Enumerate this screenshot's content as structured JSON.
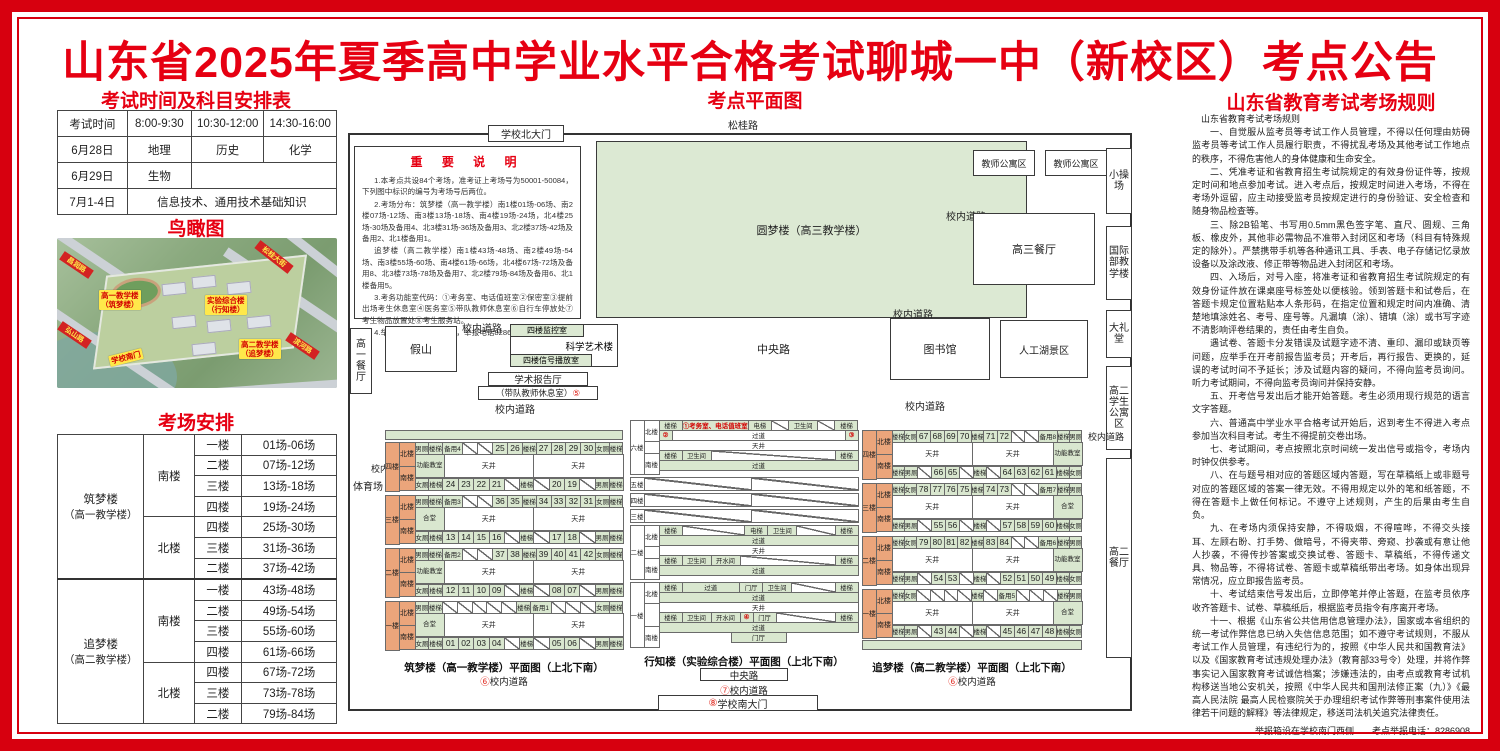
{
  "title": "山东省2025年夏季高中学业水平合格考试聊城一中（新校区）考点公告",
  "left": {
    "schedule": {
      "title": "考试时间及科目安排表",
      "header": [
        "考试时间",
        "8:00-9:30",
        "10:30-12:00",
        "14:30-16:00"
      ],
      "row1": [
        "6月28日",
        "地理",
        "历史",
        "化学"
      ],
      "row2": [
        "6月29日",
        "生物"
      ],
      "row3": [
        "7月1-4日",
        "信息技术、通用技术基础知识"
      ]
    },
    "aerial": {
      "title": "鸟瞰图",
      "labels": [
        {
          "text": "高一教学楼（筑梦楼）",
          "two": "高一教学楼|（筑梦楼）",
          "x": 42,
          "y": 52
        },
        {
          "text": "实验综合楼（行知楼）",
          "two": "实验综合楼|（行知楼）",
          "x": 148,
          "y": 57
        },
        {
          "text": "高二教学楼（追梦楼）",
          "two": "高二教学楼|（追梦楼）",
          "x": 182,
          "y": 101
        },
        {
          "text": "学校南门",
          "two": "学校南门",
          "x": 52,
          "y": 114,
          "rot": -14
        }
      ],
      "ribbons": [
        {
          "text": "昌润路",
          "x": 2,
          "y": 22,
          "rot": 34
        },
        {
          "text": "松桂大街",
          "x": 196,
          "y": 14,
          "rot": 38
        },
        {
          "text": "弘山路",
          "x": 0,
          "y": 92,
          "rot": 34
        },
        {
          "text": "滨河路",
          "x": 228,
          "y": 103,
          "rot": 34
        }
      ]
    },
    "arrangement": {
      "title": "考场安排",
      "groups": [
        {
          "building": "筑梦楼（高一教学楼）",
          "wings": [
            {
              "wing": "南楼",
              "rows": [
                [
                  "一楼",
                  "01场-06场"
                ],
                [
                  "二楼",
                  "07场-12场"
                ],
                [
                  "三楼",
                  "13场-18场"
                ],
                [
                  "四楼",
                  "19场-24场"
                ]
              ]
            },
            {
              "wing": "北楼",
              "rows": [
                [
                  "四楼",
                  "25场-30场"
                ],
                [
                  "三楼",
                  "31场-36场"
                ],
                [
                  "二楼",
                  "37场-42场"
                ]
              ]
            }
          ]
        },
        {
          "building": "追梦楼（高二教学楼）",
          "wings": [
            {
              "wing": "南楼",
              "rows": [
                [
                  "一楼",
                  "43场-48场"
                ],
                [
                  "二楼",
                  "49场-54场"
                ],
                [
                  "三楼",
                  "55场-60场"
                ],
                [
                  "四楼",
                  "61场-66场"
                ]
              ]
            },
            {
              "wing": "北楼",
              "rows": [
                [
                  "四楼",
                  "67场-72场"
                ],
                [
                  "三楼",
                  "73场-78场"
                ],
                [
                  "二楼",
                  "79场-84场"
                ]
              ]
            }
          ]
        }
      ]
    }
  },
  "map": {
    "title": "考点平面图",
    "labels": {
      "songgui_road": "松桂路",
      "north_gate": "学校北大门",
      "yuanmeng": "圆梦楼（高三教学楼）",
      "teacher_apt1": "教师公寓区",
      "teacher_apt2": "教师公寓区",
      "small_playground": "小操场",
      "gaosan_canteen": "高三餐厅",
      "intl_dept": "国际部教学楼",
      "auditorium": "大礼堂",
      "gaoer_apartment": "高二学生公寓区",
      "gaoer_canteen": "高二餐厅",
      "inner_road": "校内道路",
      "central_road": "中央路",
      "gaoyi_canteen": "高一餐厅",
      "rockery": "假山",
      "monitor_room": "四楼监控室",
      "sci_art_bldg": "科学艺术楼",
      "signal_room": "四楼信号播放室",
      "lecture_hall": "学术报告厅",
      "team_teacher_rest": "（带队教师休息室）",
      "team_teacher_num": "⑤",
      "library": "图书馆",
      "lake": "人工湖景区",
      "stadium": "体育场",
      "south_gate": "学校南大门",
      "south_gate_num": "⑧",
      "central_road_num7": "⑦",
      "road_num6": "⑥"
    },
    "notes": {
      "title": "重 要 说 明",
      "items": [
        "1.本考点共设84个考场，准考证上考场号为50001-50084，下列图中标识的编号为考场号后两位。",
        "2.考场分布：筑梦楼（高一教学楼）南1楼01场-06场、南2楼07场-12场、南3楼13场-18场、南4楼19场-24场，北4楼25场-30场及备用4、北3楼31场-36场及备用3、北2楼37场-42场及备用2、北1楼备用1。",
        "追梦楼（高二教学楼）南1楼43场-48场、南2楼49场-54场、南3楼55场-60场、南4楼61场-66场，北4楼67场-72场及备用8、北3楼73场-78场及备用7、北2楼79场-84场及备用6、北1楼备用5。",
        "3.考务功能室代码：①考务室、电话值班室②保密室③提前出场考生休息室④医务室⑤带队教师休息室⑥自行车停放处⑦考生物品放置处⑧考生服务站。",
        "4.举报箱设在南大门西侧，举报电话8286908。"
      ]
    },
    "plans": {
      "zhumeng": {
        "caption": "筑梦楼（高一教学楼）平面图（上北下南）",
        "road_num": "⑥",
        "road": "校内道路",
        "label_side": "west",
        "strip": "top",
        "floors": [
          {
            "name": "四楼",
            "mid": "功能教室",
            "north": [
              "男厕",
              "楼梯",
              "备用4",
              "/",
              "/",
              "25",
              "26",
              "楼梯",
              "27",
              "28",
              "29",
              "30",
              "女厕",
              "楼梯"
            ],
            "south": [
              "女厕",
              "楼梯",
              "24",
              "23",
              "22",
              "21",
              "/",
              "楼梯",
              "/",
              "20",
              "19",
              "/",
              "男厕",
              "楼梯"
            ]
          },
          {
            "name": "三楼",
            "mid": "合堂",
            "north": [
              "男厕",
              "楼梯",
              "备用3",
              "/",
              "/",
              "36",
              "35",
              "楼梯",
              "34",
              "33",
              "32",
              "31",
              "女厕",
              "楼梯"
            ],
            "south": [
              "女厕",
              "楼梯",
              "13",
              "14",
              "15",
              "16",
              "/",
              "楼梯",
              "/",
              "17",
              "18",
              "/",
              "男厕",
              "楼梯"
            ]
          },
          {
            "name": "二楼",
            "mid": "功能教室",
            "north": [
              "男厕",
              "楼梯",
              "备用2",
              "/",
              "/",
              "37",
              "38",
              "楼梯",
              "39",
              "40",
              "41",
              "42",
              "女厕",
              "楼梯"
            ],
            "south": [
              "女厕",
              "楼梯",
              "12",
              "11",
              "10",
              "09",
              "/",
              "楼梯",
              "/",
              "08",
              "07",
              "/",
              "男厕",
              "楼梯"
            ]
          },
          {
            "name": "一楼",
            "mid": "合堂",
            "north": [
              "男厕",
              "楼梯",
              "/",
              "/",
              "/",
              "/",
              "/",
              "楼梯",
              "备用1",
              "/",
              "/",
              "/",
              "女厕",
              "楼梯"
            ],
            "south": [
              "女厕",
              "楼梯",
              "01",
              "02",
              "03",
              "04",
              "/",
              "楼梯",
              "/",
              "05",
              "06",
              "/",
              "男厕",
              "楼梯"
            ]
          }
        ]
      },
      "zhuimeng": {
        "caption": "追梦楼（高二教学楼）平面图（上北下南）",
        "road_num": "⑥",
        "road": "校内道路",
        "label_side": "east",
        "strip": "bottom",
        "floors": [
          {
            "name": "四楼",
            "mid": "功能教室",
            "north": [
              "楼梯",
              "女厕",
              "67",
              "68",
              "69",
              "70",
              "楼梯",
              "71",
              "72",
              "/",
              "/",
              "备用8",
              "楼梯",
              "男厕"
            ],
            "south": [
              "楼梯",
              "男厕",
              "/",
              "66",
              "65",
              "/",
              "楼梯",
              "/",
              "64",
              "63",
              "62",
              "61",
              "楼梯",
              "女厕"
            ]
          },
          {
            "name": "三楼",
            "mid": "合堂",
            "north": [
              "楼梯",
              "女厕",
              "78",
              "77",
              "76",
              "75",
              "楼梯",
              "74",
              "73",
              "/",
              "/",
              "备用7",
              "楼梯",
              "男厕"
            ],
            "south": [
              "楼梯",
              "男厕",
              "/",
              "55",
              "56",
              "/",
              "楼梯",
              "/",
              "57",
              "58",
              "59",
              "60",
              "楼梯",
              "女厕"
            ]
          },
          {
            "name": "二楼",
            "mid": "功能教室",
            "north": [
              "楼梯",
              "女厕",
              "79",
              "80",
              "81",
              "82",
              "楼梯",
              "83",
              "84",
              "/",
              "/",
              "备用6",
              "楼梯",
              "男厕"
            ],
            "south": [
              "楼梯",
              "男厕",
              "/",
              "54",
              "53",
              "/",
              "楼梯",
              "/",
              "52",
              "51",
              "50",
              "49",
              "楼梯",
              "女厕"
            ]
          },
          {
            "name": "一楼",
            "mid": "合堂",
            "north": [
              "楼梯",
              "女厕",
              "/",
              "/",
              "/",
              "/",
              "楼梯",
              "/",
              "备用5",
              "/",
              "/",
              "/",
              "楼梯",
              "男厕"
            ],
            "south": [
              "楼梯",
              "男厕",
              "/",
              "43",
              "44",
              "/",
              "楼梯",
              "/",
              "45",
              "46",
              "47",
              "48",
              "楼梯",
              "女厕"
            ]
          }
        ]
      },
      "xingzhi": {
        "caption": "行知楼（实验综合楼）平面图（上北下南）",
        "bottom_road1": "中央路",
        "bottom_road2_num": "⑦",
        "bottom_road2": "校内道路",
        "gate_num": "⑧",
        "gate": "学校南大门",
        "floors": [
          {
            "name": "六楼",
            "wings": true,
            "rows": [
              [
                {
                  "t": "楼梯"
                },
                {
                  "t": "①考务室、电话值班室",
                  "red": 1,
                  "f": 3.2
                },
                {
                  "t": "电梯"
                },
                {
                  "t": "/",
                  "f": 0.8
                },
                {
                  "t": "卫生间"
                },
                {
                  "t": "/",
                  "f": 0.8
                },
                {
                  "t": "楼梯"
                }
              ],
              [
                {
                  "t": "②",
                  "red": 1
                },
                {
                  "t": "过道",
                  "f": 5,
                  "white": 1
                },
                {
                  "t": "③",
                  "red": 1
                }
              ],
              [
                {
                  "t": "天井",
                  "f": 1,
                  "white": 1
                }
              ],
              [
                {
                  "t": "楼梯"
                },
                {
                  "t": "卫生间"
                },
                {
                  "t": "/",
                  "f": 3.4,
                  "white": 1
                },
                {
                  "t": "楼梯"
                }
              ],
              [
                {
                  "t": "过道",
                  "f": 1
                }
              ]
            ]
          },
          {
            "name": "五楼",
            "rows": [
              [
                {
                  "t": "/",
                  "f": 1,
                  "white": 1
                },
                {
                  "t": "/",
                  "f": 1,
                  "white": 1
                }
              ]
            ]
          },
          {
            "name": "四楼",
            "rows": [
              [
                {
                  "t": "/",
                  "f": 1,
                  "white": 1
                },
                {
                  "t": "/",
                  "f": 1,
                  "white": 1
                }
              ]
            ]
          },
          {
            "name": "三楼",
            "rows": [
              [
                {
                  "t": "/",
                  "f": 1,
                  "white": 1
                },
                {
                  "t": "/",
                  "f": 1,
                  "white": 1
                }
              ]
            ]
          },
          {
            "name": "二楼",
            "wings": true,
            "rows": [
              [
                {
                  "t": "楼梯"
                },
                {
                  "t": "/",
                  "f": 2,
                  "white": 1
                },
                {
                  "t": "电梯"
                },
                {
                  "t": "卫生间"
                },
                {
                  "t": "/",
                  "f": 1.2,
                  "white": 1
                },
                {
                  "t": "楼梯"
                }
              ],
              [
                {
                  "t": "过道",
                  "f": 1
                }
              ],
              [
                {
                  "t": "天井",
                  "f": 1,
                  "white": 1
                }
              ],
              [
                {
                  "t": "楼梯"
                },
                {
                  "t": "卫生间"
                },
                {
                  "t": "开水间"
                },
                {
                  "t": "/",
                  "f": 2,
                  "white": 1
                },
                {
                  "t": "楼梯"
                }
              ],
              [
                {
                  "t": "过道",
                  "f": 1
                }
              ]
            ]
          },
          {
            "name": "一楼",
            "wings": true,
            "rows": [
              [
                {
                  "t": "楼梯"
                },
                {
                  "t": "过道",
                  "f": 1.6
                },
                {
                  "t": "门厅"
                },
                {
                  "t": "卫生间"
                },
                {
                  "t": "/",
                  "f": 1.2,
                  "white": 1
                },
                {
                  "t": "楼梯"
                }
              ],
              [
                {
                  "t": "过道",
                  "f": 1
                }
              ],
              [
                {
                  "t": "天井",
                  "f": 1,
                  "white": 1
                }
              ],
              [
                {
                  "t": "楼梯"
                },
                {
                  "t": "卫生间"
                },
                {
                  "t": "开水间"
                },
                {
                  "t": "④",
                  "red": 1
                },
                {
                  "t": "门厅"
                },
                {
                  "t": "/",
                  "f": 1,
                  "white": 1
                },
                {
                  "t": "楼梯"
                }
              ],
              [
                {
                  "t": "过道",
                  "f": 1
                }
              ],
              [
                {
                  "t": "门厅",
                  "solo": 1
                }
              ]
            ]
          }
        ]
      }
    }
  },
  "rules": {
    "title": "山东省教育考试考场规则",
    "intro": "山东省教育考试考场规则",
    "paragraphs": [
      "一、自觉服从监考员等考试工作人员管理，不得以任何理由妨碍监考员等考试工作人员履行职责，不得扰乱考场及其他考试工作地点的秩序，不得危害他人的身体健康和生命安全。",
      "二、凭准考证和省教育招生考试院规定的有效身份证件等，按规定时间和地点参加考试。进入考点后，按规定时间进入考场，不得在考场外逗留，应主动接受监考员按规定进行的身份验证、安全检查和随身物品检查等。",
      "三、除2B铅笔、书写用0.5mm黑色签字笔、直尺、圆规、三角板、橡皮外，其他非必需物品不准带入封闭区和考场（科目有特殊规定的除外）。严禁携带手机等各种通讯工具、手表、电子存储记忆录放设备以及涂改液、修正带等物品进入封闭区和考场。",
      "四、入场后，对号入座，将准考证和省教育招生考试院规定的有效身份证件放在课桌座号标签处以便核验。领到答题卡和试卷后，在答题卡规定位置粘贴本人条形码，在指定位置和规定时间内准确、清楚地填涂姓名、考号、座号等。凡漏填（涂）、错填（涂）或书写字迹不清影响评卷结果的，责任由考生自负。",
      "遇试卷、答题卡分发错误及试题字迹不清、重印、漏印或缺页等问题，应举手在开考前报告监考员；开考后，再行报告、更换的，延误的考试时间不予延长；涉及试题内容的疑问，不得向监考员询问。听力考试期间，不得向监考员询问并保持安静。",
      "五、开考信号发出后才能开始答题。考生必须用现行规范的语言文字答题。",
      "六、普通高中学业水平合格考试开始后，迟到考生不得进入考点参加当次科目考试。考生不得提前交卷出场。",
      "七、考试期间，考点按照北京时间统一发出信号或指令，考场内时钟仅供参考。",
      "八、在与题号相对应的答题区域内答题，写在草稿纸上或非题号对应的答题区域的答案一律无效。不得用规定以外的笔和纸答题，不得在答题卡上做任何标记。不遵守上述规则，产生的后果由考生自负。",
      "九、在考场内须保持安静，不得吸烟，不得喧哗，不得交头接耳、左顾右盼、打手势、做暗号，不得夹带、旁窥、抄袭或有意让他人抄袭，不得传抄答案或交换试卷、答题卡、草稿纸，不得传递文具、物品等，不得将试卷、答题卡或草稿纸带出考场。如身体出现异常情况，应立即报告监考员。",
      "十、考试结束信号发出后，立即停笔并停止答题，在监考员依序收齐答题卡、试卷、草稿纸后，根据监考员指令有序离开考场。",
      "十一、根据《山东省公共信用信息管理办法》，国家或本省组织的统一考试作弊信息已纳入失信信息范围；如不遵守考试规则，不服从考试工作人员管理，有违纪行为的，按照《中华人民共和国教育法》以及《国家教育考试违规处理办法》（教育部33号令）处理，并将作弊事实记入国家教育考试诚信档案；涉嫌违法的，由考点或教育考试机构移送当地公安机关，按照《中华人民共和国刑法修正案（九）》《最高人民法院 最高人民检察院关于办理组织考试作弊等刑事案件使用法律若干问题的解释》等法律规定，移送司法机关追究法律责任。"
    ],
    "footer": "举报箱设在学校南门西侧　　考点举报电话：8286908"
  }
}
